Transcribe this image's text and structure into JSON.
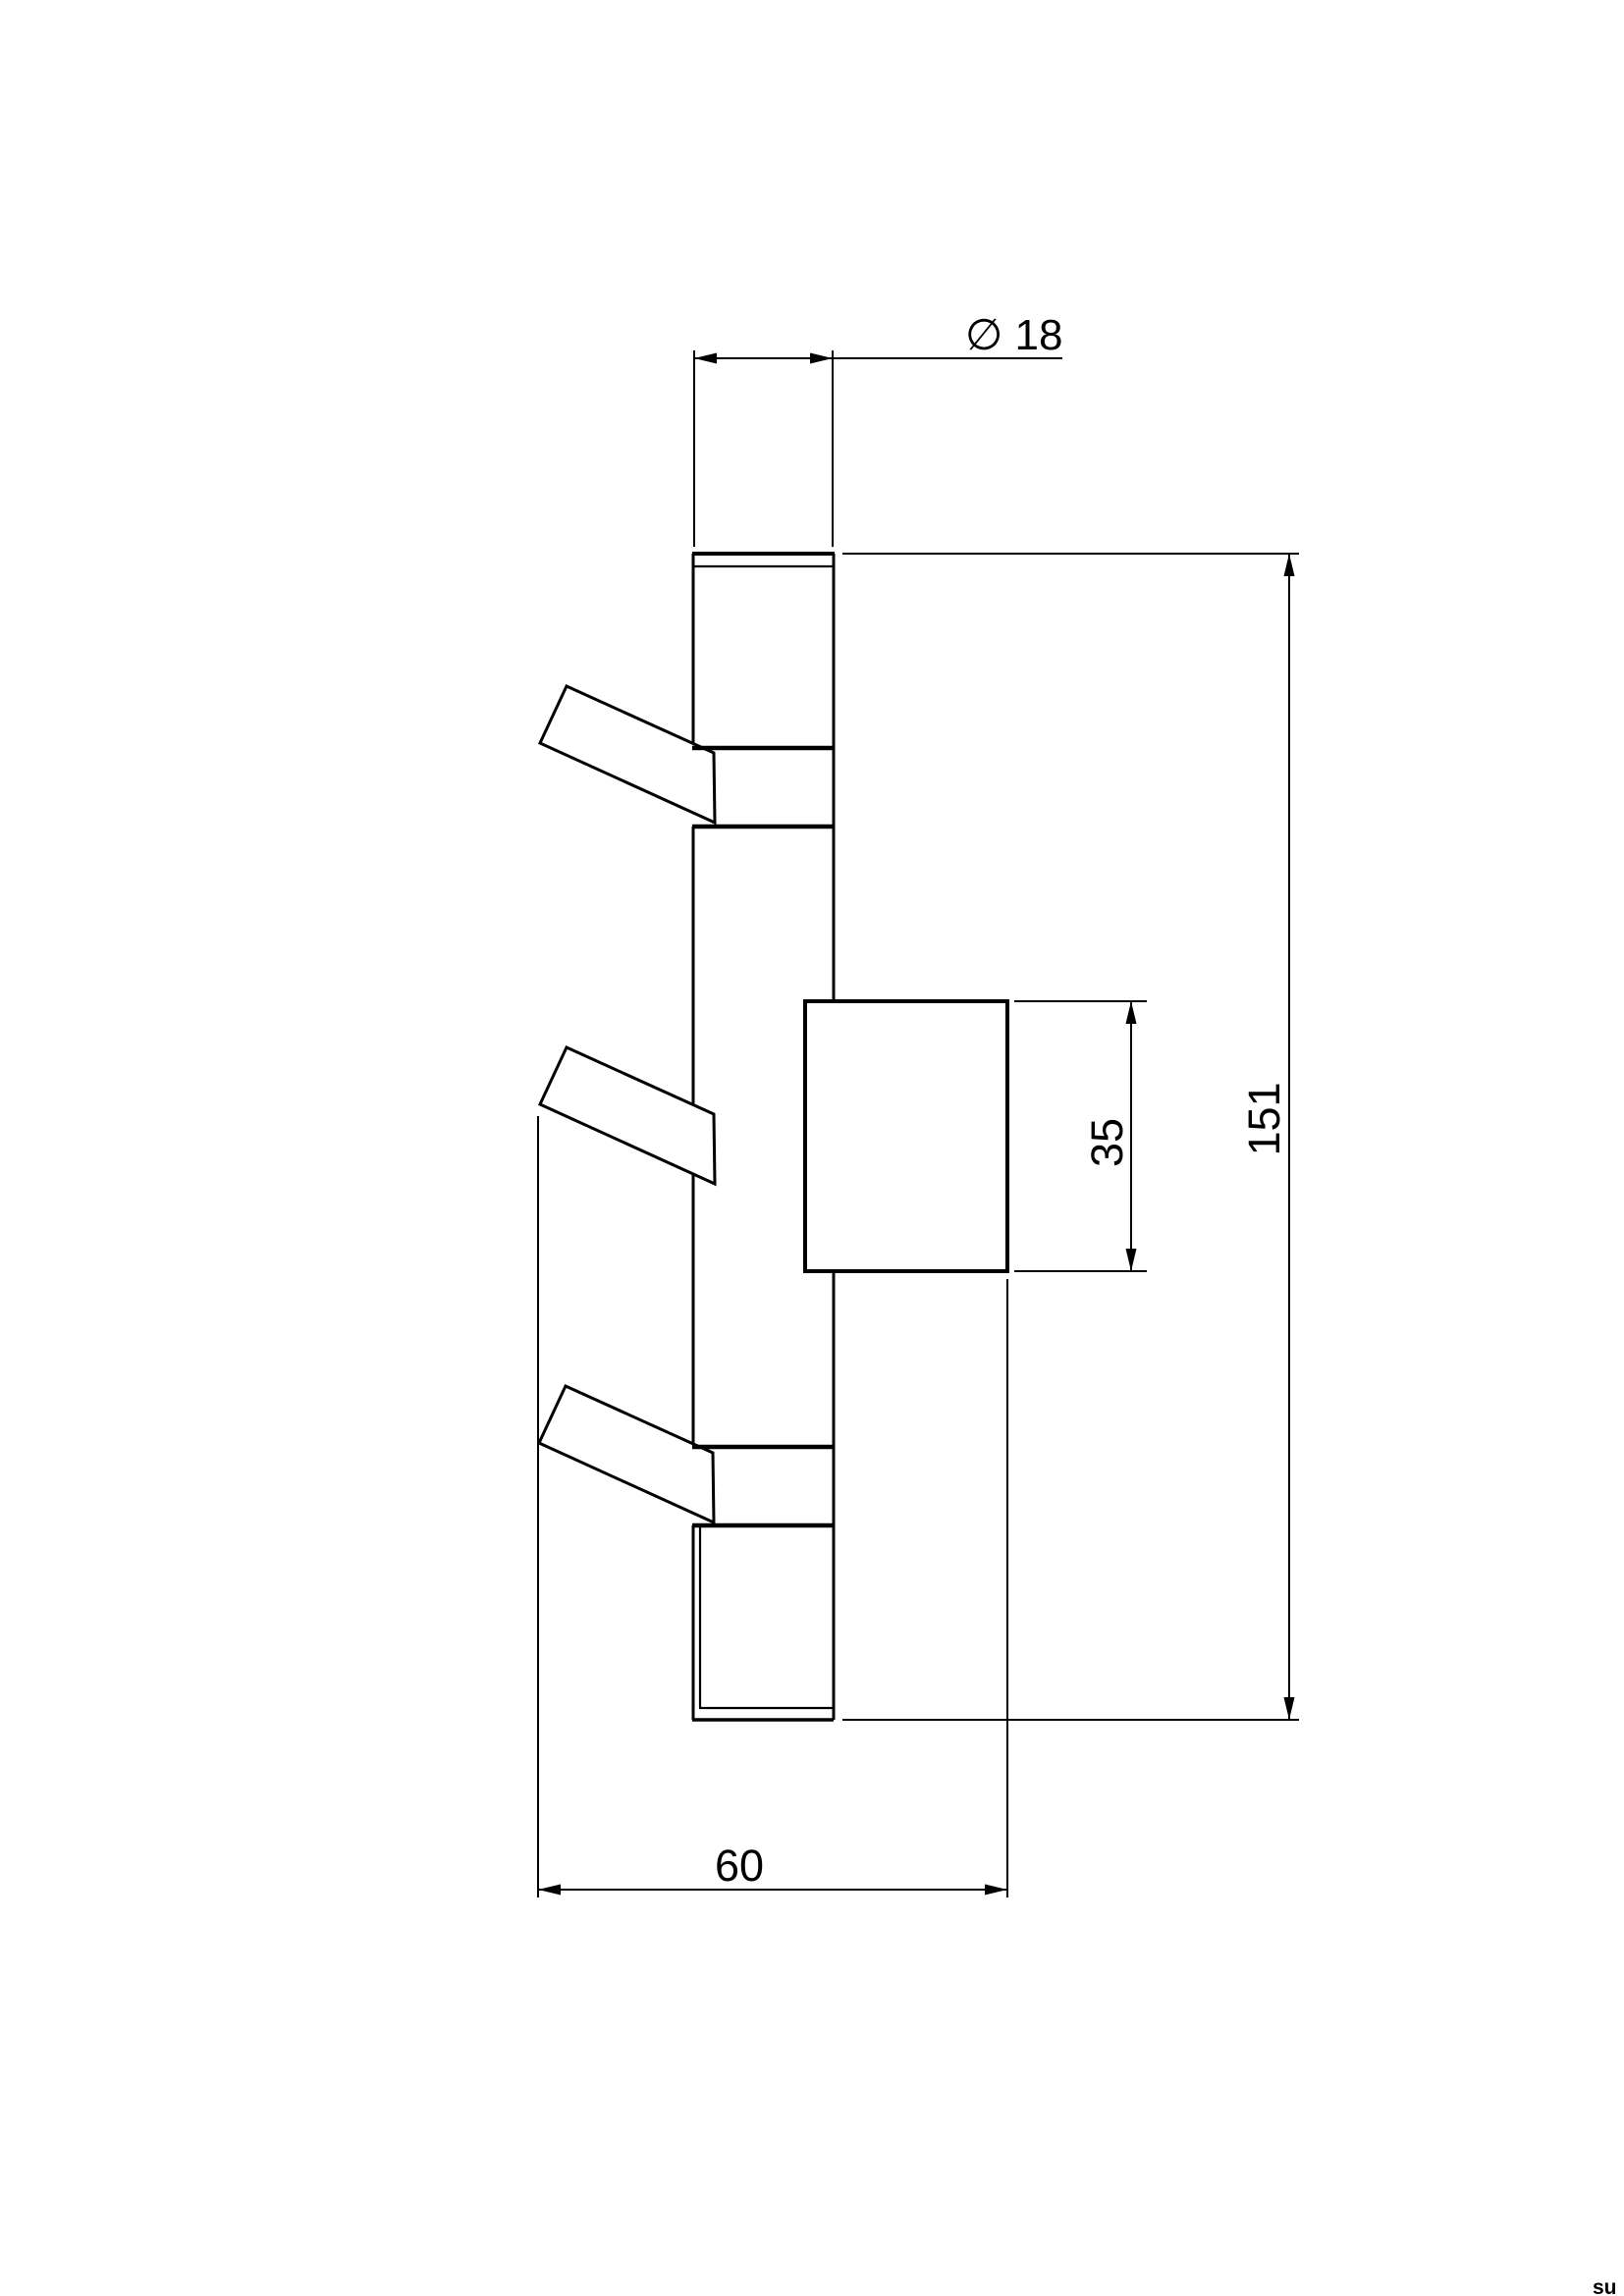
{
  "dimensions": {
    "diameter": {
      "label": "∅ 18",
      "value_mm": 18
    },
    "overall_height": {
      "label": "151",
      "value_mm": 151
    },
    "plate_height": {
      "label": "35",
      "value_mm": 35
    },
    "overall_depth": {
      "label": "60",
      "value_mm": 60
    }
  },
  "watermark": {
    "text": "su"
  },
  "colors": {
    "line": "#000000",
    "background": "#ffffff"
  }
}
